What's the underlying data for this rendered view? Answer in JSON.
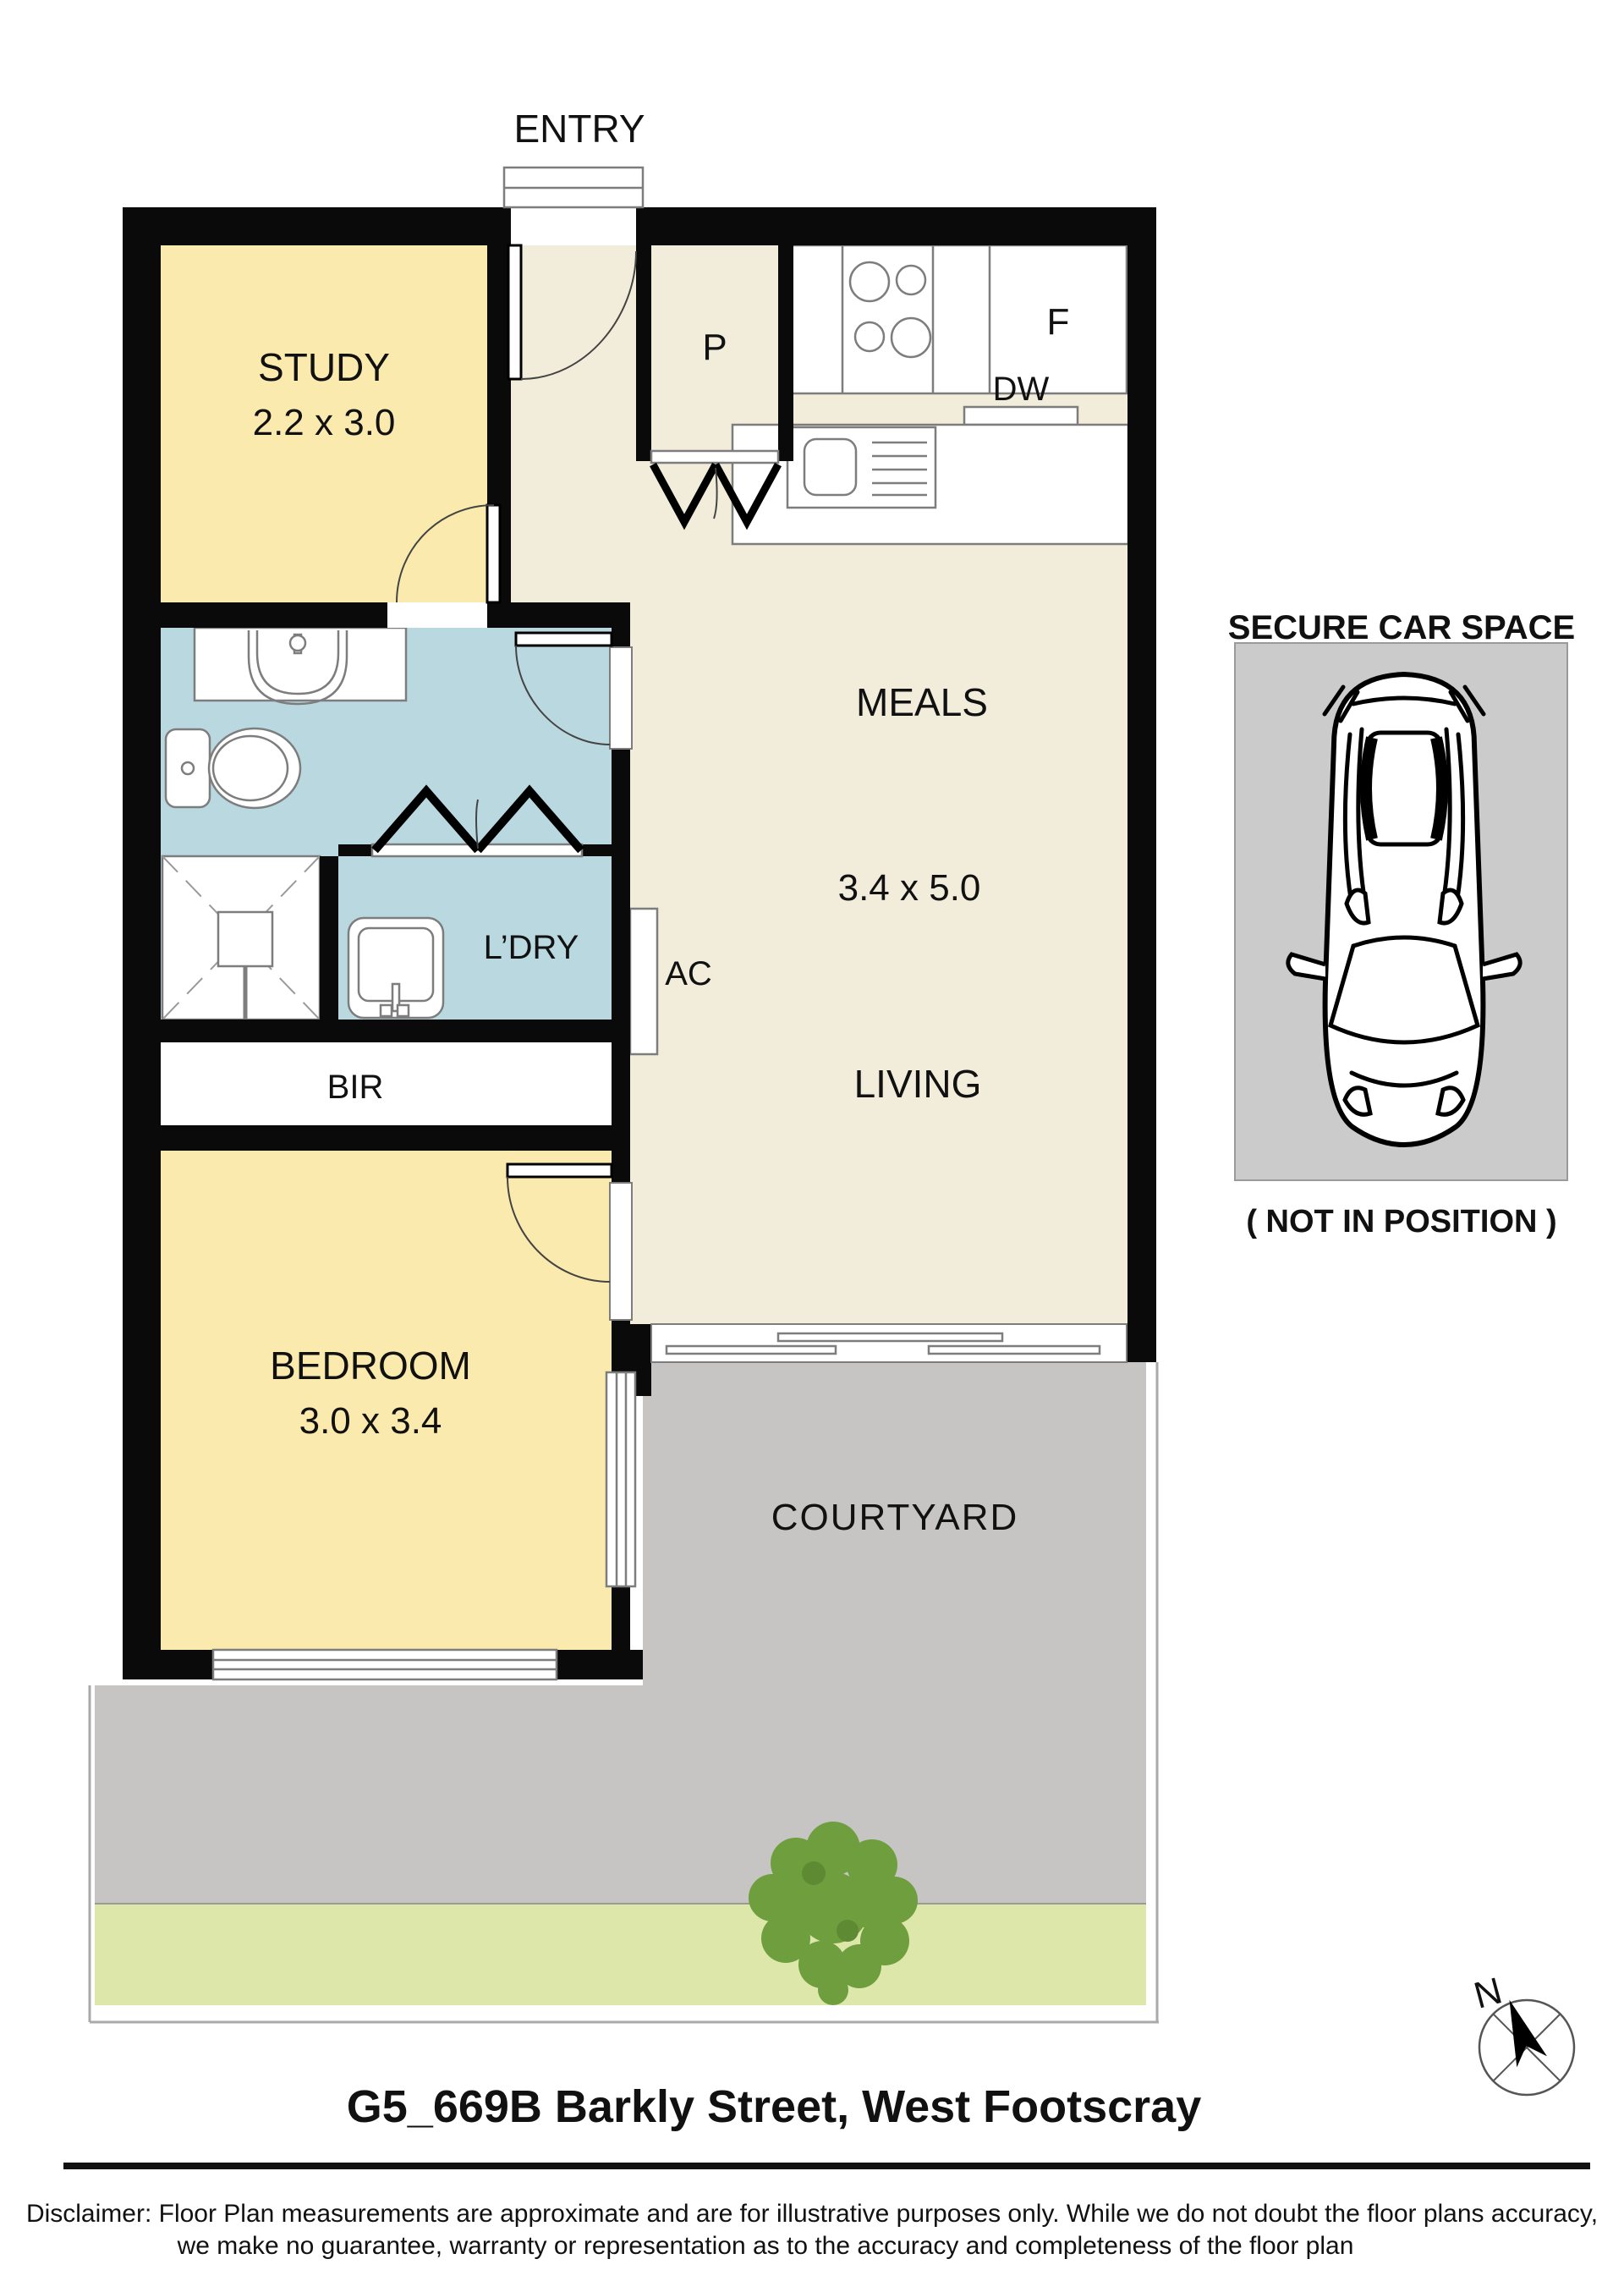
{
  "plan": {
    "entry_label": "ENTRY",
    "rooms": {
      "study": {
        "name": "STUDY",
        "dims": "2.2 x 3.0"
      },
      "meals": {
        "name": "MEALS"
      },
      "living": {
        "name": "LIVING",
        "dims": "3.4 x 5.0"
      },
      "bedroom": {
        "name": "BEDROOM",
        "dims": "3.0 x 3.4"
      },
      "laundry": {
        "name": "L’DRY"
      },
      "courtyard": {
        "name": "COURTYARD"
      }
    },
    "fixtures": {
      "pantry": "P",
      "fridge": "F",
      "dishwasher": "DW",
      "aircon": "AC",
      "robe": "BIR"
    }
  },
  "car_space": {
    "title": "SECURE CAR SPACE",
    "caption": "( NOT IN POSITION )"
  },
  "compass": {
    "north": "N"
  },
  "footer": {
    "title": "G5_669B Barkly Street, West Footscray",
    "disclaimer_line1": "Disclaimer: Floor Plan measurements are approximate and are for illustrative purposes only. While we do not doubt the floor plans accuracy,",
    "disclaimer_line2": "we make no guarantee, warranty or representation as to the accuracy and completeness of the floor plan"
  },
  "colors": {
    "floor_beige": "#F2EDDB",
    "room_yellow": "#FBEAAE",
    "bath_blue": "#B9D8E0",
    "courtyard_gray": "#C6C5C3",
    "carspace_gray": "#CBCBCB",
    "garden_green": "#DCE7A9",
    "tree_green": "#6F9E3E",
    "wall_black": "#0A0A0A"
  }
}
